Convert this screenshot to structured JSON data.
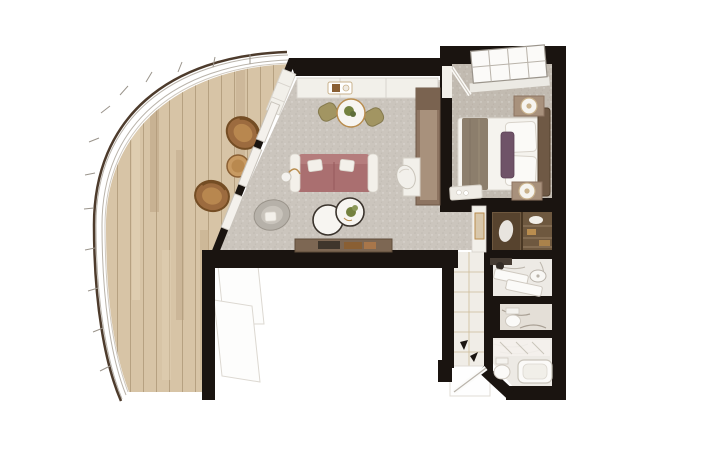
{
  "page": {
    "title": "Suite Floor Plan",
    "background": "#ffffff"
  },
  "colors": {
    "wall": "#1a1410",
    "deck": "#d7c4a6",
    "railing_edge": "#4d3b2c",
    "carpet_living": "#cbc5bd",
    "carpet_bedroom": "#c2bbb1",
    "marble": "#edeae5",
    "marble_dark": "#e4dfd7",
    "hall_tile": "#f0ede7",
    "sofa": "#aa6f70",
    "sofa_back": "#b57d7d",
    "pillow": "#f3f0ea",
    "wood": "#8d7461",
    "wood_light": "#a8917c",
    "wood_dark": "#7a6350",
    "sideboard": "#7d6753",
    "closet": "#6e583f",
    "closet_dark": "#57432e",
    "olive": "#a29562",
    "gold": "#b98d4f",
    "rattan": "#9c6b3f",
    "rattan_rim": "#744d24",
    "table_white": "#f7f5f1",
    "bed": "#f5f3ee",
    "throw": "#8c7e6c",
    "purple": "#6f5368",
    "headboard": "#6f5945",
    "gray_chair": "#b6b1a9",
    "lamp_gold": "#c9b28c",
    "mirror": "#463c33",
    "plant": "#74813f",
    "art": "#d8c7ab",
    "panel": "#fdfdfc",
    "glass": "#f4f1ec",
    "console_white": "#f2f0ea"
  },
  "plan": {
    "type": "suite-floor-plan",
    "rooms": [
      {
        "name": "private-veranda",
        "floor": "wood-deck",
        "furniture": [
          "wicker-chair",
          "wicker-chair",
          "round-side-table",
          "curved-glass-railing"
        ]
      },
      {
        "name": "living-room",
        "floor": "carpet",
        "furniture": [
          "sofa",
          "nesting-coffee-tables",
          "accent-chair",
          "floor-lamp",
          "dining-table",
          "dining-chair",
          "dining-chair",
          "wall-console",
          "sideboard",
          "media-desk-unit",
          "desk-chair",
          "sliding-glass-doors"
        ]
      },
      {
        "name": "bedroom",
        "floor": "carpet",
        "furniture": [
          "king-bed",
          "headboard",
          "nightstand",
          "nightstand",
          "table-lamp",
          "table-lamp",
          "foot-bench",
          "window"
        ]
      },
      {
        "name": "wardrobe",
        "floor": "wood",
        "furniture": [
          "shelves",
          "hanging-rail"
        ]
      },
      {
        "name": "bathroom-vanity",
        "floor": "marble",
        "furniture": [
          "counter",
          "sink",
          "mirror"
        ]
      },
      {
        "name": "toilet-room",
        "floor": "marble",
        "furniture": [
          "toilet"
        ]
      },
      {
        "name": "main-bathroom",
        "floor": "marble",
        "furniture": [
          "bathtub",
          "toilet",
          "glass-shower"
        ]
      },
      {
        "name": "entry-hall",
        "floor": "marble-tile",
        "furniture": [
          "entry-door",
          "framed-art",
          "door-swing-arrows"
        ]
      }
    ]
  }
}
